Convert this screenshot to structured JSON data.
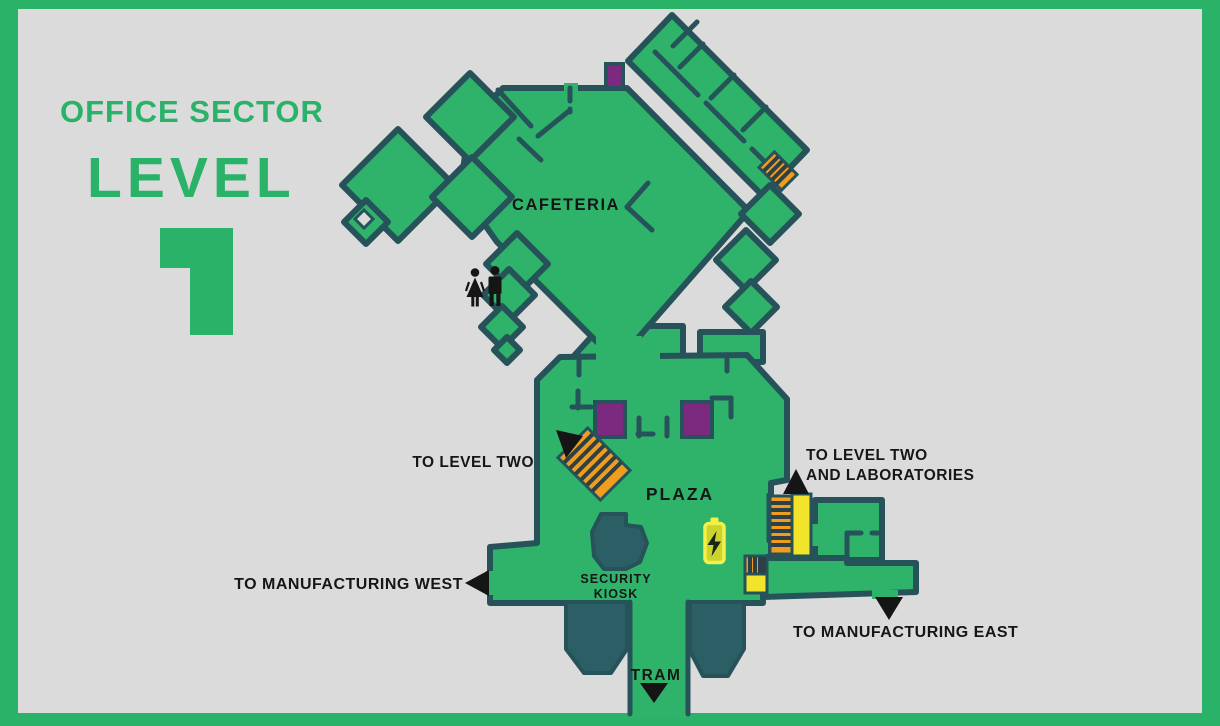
{
  "title": {
    "sector": "OFFICE SECTOR",
    "level_word": "LEVEL",
    "level_number": "1"
  },
  "map": {
    "areas": {
      "cafeteria": "CAFETERIA",
      "plaza": "PLAZA",
      "security_kiosk_line1": "SECURITY",
      "security_kiosk_line2": "KIOSK",
      "tram": "TRAM"
    },
    "directions": {
      "to_level_two": "TO LEVEL TWO",
      "to_level_two_labs_line1": "TO LEVEL TWO",
      "to_level_two_labs_line2": "AND LABORATORIES",
      "to_manufacturing_west": "TO MANUFACTURING WEST",
      "to_manufacturing_east": "TO MANUFACTURING EAST"
    },
    "icons": {
      "restroom": "restroom-icon",
      "charger": "charger-icon",
      "stairs": "stairs-marker",
      "elevator_purple": "elevator-marker",
      "lift_yellow": "lift-marker",
      "security_kiosk": "security-kiosk-structure",
      "tram_platform": "tram-platform",
      "direction_arrow": "direction-arrow"
    },
    "colors": {
      "frame_green": "#2bb269",
      "map_green": "#2fb36b",
      "wall_teal": "#26535a",
      "structure_teal": "#2b5e65",
      "elevator_purple": "#7b2a80",
      "stairs_orange": "#f09d1e",
      "lift_yellow": "#f2e32b",
      "charger_yellow": "#f4f04a",
      "background_gray": "#dcdbdb",
      "label_black": "#161616"
    }
  }
}
